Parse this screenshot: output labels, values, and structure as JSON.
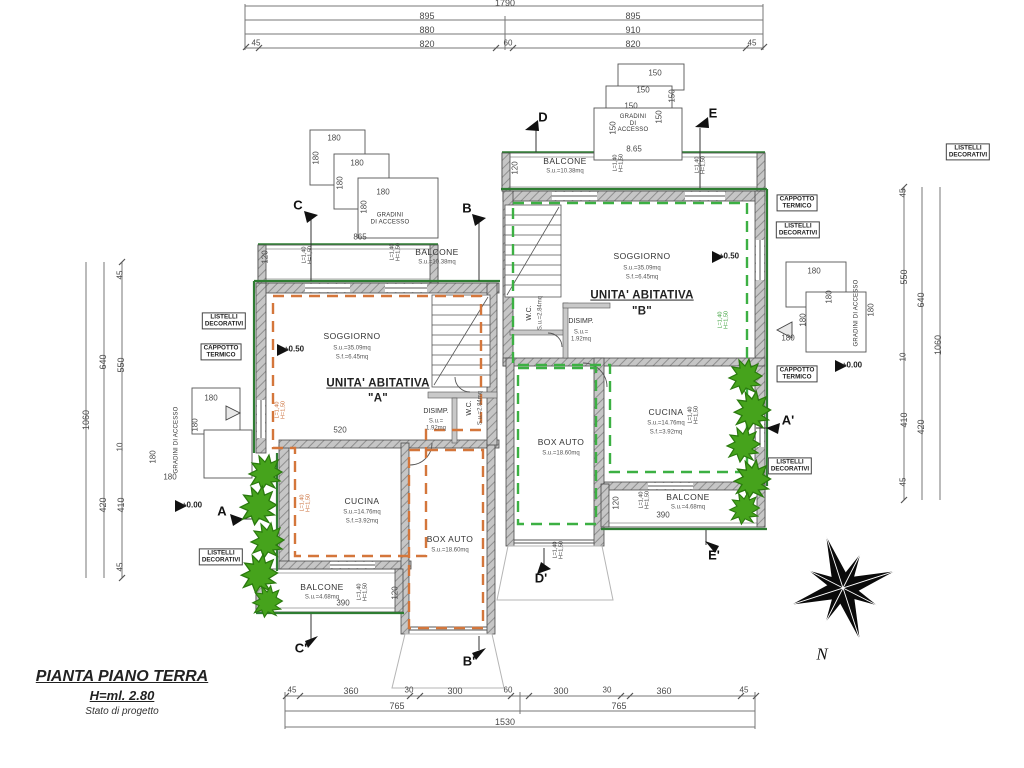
{
  "meta": {
    "width": 1024,
    "height": 768,
    "drawing_type": "floor plan"
  },
  "title_block": {
    "title": "PIANTA PIANO TERRA",
    "height_label": "H=ml. 2.80",
    "status": "Stato di progetto"
  },
  "compass": {
    "north_label": "N"
  },
  "colors": {
    "wall_fill": "#c6c6c6",
    "wall_edge": "#4a4a4a",
    "trim_green": "#2e7d32",
    "unit_a_dash": "#d4763b",
    "unit_b_dash": "#3cb043",
    "foliage": "#46a31c",
    "dim_line": "#777777"
  },
  "annotations": [
    {
      "n": "dim-top-total",
      "c": "dim",
      "t": "1790",
      "x": 505,
      "y": 3
    },
    {
      "n": "dim-top-895-left",
      "c": "dim",
      "t": "895",
      "x": 427,
      "y": 16
    },
    {
      "n": "dim-top-895-right",
      "c": "dim",
      "t": "895",
      "x": 633,
      "y": 16
    },
    {
      "n": "dim-top-880",
      "c": "dim",
      "t": "880",
      "x": 427,
      "y": 30
    },
    {
      "n": "dim-top-910",
      "c": "dim",
      "t": "910",
      "x": 633,
      "y": 30
    },
    {
      "n": "dim-top-45-left",
      "c": "dimsm",
      "t": "45",
      "x": 256,
      "y": 44
    },
    {
      "n": "dim-top-820-left",
      "c": "dim",
      "t": "820",
      "x": 427,
      "y": 44
    },
    {
      "n": "dim-top-60",
      "c": "dimsm",
      "t": "60",
      "x": 508,
      "y": 44
    },
    {
      "n": "dim-top-820-right",
      "c": "dim",
      "t": "820",
      "x": 633,
      "y": 44
    },
    {
      "n": "dim-top-45-right",
      "c": "dimsm",
      "t": "45",
      "x": 752,
      "y": 44
    },
    {
      "n": "dim-bot-45-a",
      "c": "dimsm",
      "t": "45",
      "x": 292,
      "y": 691
    },
    {
      "n": "dim-bot-360-a",
      "c": "dim",
      "t": "360",
      "x": 351,
      "y": 691
    },
    {
      "n": "dim-bot-30-a",
      "c": "dimsm",
      "t": "30",
      "x": 409,
      "y": 691
    },
    {
      "n": "dim-bot-300-a",
      "c": "dim",
      "t": "300",
      "x": 455,
      "y": 691
    },
    {
      "n": "dim-bot-60",
      "c": "dimsm",
      "t": "60",
      "x": 508,
      "y": 691
    },
    {
      "n": "dim-bot-300-b",
      "c": "dim",
      "t": "300",
      "x": 561,
      "y": 691
    },
    {
      "n": "dim-bot-30-b",
      "c": "dimsm",
      "t": "30",
      "x": 607,
      "y": 691
    },
    {
      "n": "dim-bot-360-b",
      "c": "dim",
      "t": "360",
      "x": 664,
      "y": 691
    },
    {
      "n": "dim-bot-45-b",
      "c": "dimsm",
      "t": "45",
      "x": 744,
      "y": 691
    },
    {
      "n": "dim-bot-765-a",
      "c": "dim",
      "t": "765",
      "x": 397,
      "y": 706
    },
    {
      "n": "dim-bot-765-b",
      "c": "dim",
      "t": "765",
      "x": 619,
      "y": 706
    },
    {
      "n": "dim-bot-1530",
      "c": "dim",
      "t": "1530",
      "x": 505,
      "y": 722
    },
    {
      "n": "dim-left-1060",
      "c": "dim",
      "t": "1060",
      "x": 86,
      "y": 420,
      "r": -90
    },
    {
      "n": "dim-left-640",
      "c": "dim",
      "t": "640",
      "x": 103,
      "y": 362,
      "r": -90
    },
    {
      "n": "dim-left-420",
      "c": "dim",
      "t": "420",
      "x": 103,
      "y": 505,
      "r": -90
    },
    {
      "n": "dim-left-45-top",
      "c": "dimsm",
      "t": "45",
      "x": 121,
      "y": 275,
      "r": -90
    },
    {
      "n": "dim-left-550",
      "c": "dim",
      "t": "550",
      "x": 121,
      "y": 365,
      "r": -90
    },
    {
      "n": "dim-left-10",
      "c": "dimsm",
      "t": "10",
      "x": 121,
      "y": 447,
      "r": -90
    },
    {
      "n": "dim-left-410",
      "c": "dim",
      "t": "410",
      "x": 121,
      "y": 505,
      "r": -90
    },
    {
      "n": "dim-left-45-bot",
      "c": "dimsm",
      "t": "45",
      "x": 121,
      "y": 567,
      "r": -90
    },
    {
      "n": "dim-right-1060",
      "c": "dim",
      "t": "1060",
      "x": 938,
      "y": 345,
      "r": -90
    },
    {
      "n": "dim-right-640",
      "c": "dim",
      "t": "640",
      "x": 921,
      "y": 300,
      "r": -90
    },
    {
      "n": "dim-right-420",
      "c": "dim",
      "t": "420",
      "x": 921,
      "y": 427,
      "r": -90
    },
    {
      "n": "dim-right-45-top",
      "c": "dimsm",
      "t": "45",
      "x": 904,
      "y": 193,
      "r": -90
    },
    {
      "n": "dim-right-550",
      "c": "dim",
      "t": "550",
      "x": 904,
      "y": 277,
      "r": -90
    },
    {
      "n": "dim-right-10",
      "c": "dimsm",
      "t": "10",
      "x": 904,
      "y": 357,
      "r": -90
    },
    {
      "n": "dim-right-410",
      "c": "dim",
      "t": "410",
      "x": 904,
      "y": 420,
      "r": -90
    },
    {
      "n": "dim-right-45-bot",
      "c": "dimsm",
      "t": "45",
      "x": 904,
      "y": 482,
      "r": -90
    },
    {
      "n": "dim-865",
      "c": "dimsm",
      "t": "865",
      "x": 360,
      "y": 238
    },
    {
      "n": "dim-865-b",
      "c": "dimsm",
      "t": "8.65",
      "x": 634,
      "y": 150
    },
    {
      "n": "dim-520",
      "c": "dimsm",
      "t": "520",
      "x": 340,
      "y": 431
    },
    {
      "n": "dim-390-a",
      "c": "dimsm",
      "t": "390",
      "x": 343,
      "y": 604
    },
    {
      "n": "dim-390-b",
      "c": "dimsm",
      "t": "390",
      "x": 663,
      "y": 516
    },
    {
      "n": "dim-120-a-top",
      "c": "dimsm",
      "t": "120",
      "x": 266,
      "y": 257,
      "r": -90
    },
    {
      "n": "dim-120-a-bot",
      "c": "dimsm",
      "t": "120",
      "x": 396,
      "y": 593,
      "r": -90
    },
    {
      "n": "dim-120-b-top",
      "c": "dimsm",
      "t": "120",
      "x": 516,
      "y": 168,
      "r": -90
    },
    {
      "n": "dim-120-b-bot",
      "c": "dimsm",
      "t": "120",
      "x": 617,
      "y": 503,
      "r": -90
    },
    {
      "n": "dim-180-tl1",
      "c": "dimsm",
      "t": "180",
      "x": 334,
      "y": 139
    },
    {
      "n": "dim-180-tl2",
      "c": "dimsm",
      "t": "180",
      "x": 357,
      "y": 164
    },
    {
      "n": "dim-180-tl3",
      "c": "dimsm",
      "t": "180",
      "x": 383,
      "y": 193
    },
    {
      "n": "dim-180-tl4",
      "c": "dimsm",
      "t": "180",
      "x": 317,
      "y": 158,
      "r": -90
    },
    {
      "n": "dim-180-tl5",
      "c": "dimsm",
      "t": "180",
      "x": 341,
      "y": 183,
      "r": -90
    },
    {
      "n": "dim-180-tl6",
      "c": "dimsm",
      "t": "180",
      "x": 365,
      "y": 207,
      "r": -90
    },
    {
      "n": "dim-150-tc1",
      "c": "dimsm",
      "t": "150",
      "x": 655,
      "y": 74
    },
    {
      "n": "dim-150-tc2",
      "c": "dimsm",
      "t": "150",
      "x": 643,
      "y": 91
    },
    {
      "n": "dim-150-tc3",
      "c": "dimsm",
      "t": "150",
      "x": 631,
      "y": 107
    },
    {
      "n": "dim-150-tc4",
      "c": "dimsm",
      "t": "150",
      "x": 673,
      "y": 96,
      "r": -90
    },
    {
      "n": "dim-150-tc5",
      "c": "dimsm",
      "t": "150",
      "x": 660,
      "y": 117,
      "r": -90
    },
    {
      "n": "dim-150-tc6",
      "c": "dimsm",
      "t": "150",
      "x": 614,
      "y": 128,
      "r": -90
    },
    {
      "n": "dim-180-r1",
      "c": "dimsm",
      "t": "180",
      "x": 814,
      "y": 272
    },
    {
      "n": "dim-180-r2",
      "c": "dimsm",
      "t": "180",
      "x": 788,
      "y": 339
    },
    {
      "n": "dim-180-r3",
      "c": "dimsm",
      "t": "180",
      "x": 830,
      "y": 297,
      "r": -90
    },
    {
      "n": "dim-180-r4",
      "c": "dimsm",
      "t": "180",
      "x": 804,
      "y": 320,
      "r": -90
    },
    {
      "n": "dim-180-r5",
      "c": "dimsm",
      "t": "180",
      "x": 872,
      "y": 310,
      "r": -90
    },
    {
      "n": "dim-180-l1",
      "c": "dimsm",
      "t": "180",
      "x": 211,
      "y": 399
    },
    {
      "n": "dim-180-l2",
      "c": "dimsm",
      "t": "180",
      "x": 170,
      "y": 478
    },
    {
      "n": "dim-180-l3",
      "c": "dimsm",
      "t": "180",
      "x": 196,
      "y": 425,
      "r": -90
    },
    {
      "n": "dim-180-l4",
      "c": "dimsm",
      "t": "180",
      "x": 154,
      "y": 457,
      "r": -90
    },
    {
      "n": "room-soggiorno-a",
      "c": "room",
      "t": "SOGGIORNO",
      "x": 352,
      "y": 337
    },
    {
      "n": "area-soggiorno-a-1",
      "c": "area",
      "t": "S.u.=35.09mq",
      "x": 352,
      "y": 349
    },
    {
      "n": "area-soggiorno-a-2",
      "c": "area",
      "t": "S.f.=6.45mq",
      "x": 352,
      "y": 358
    },
    {
      "n": "unit-a-title",
      "c": "bigu",
      "t": "UNITA' ABITATIVA",
      "x": 378,
      "y": 384
    },
    {
      "n": "unit-a-letter",
      "c": "big",
      "t": "\"A\"",
      "x": 378,
      "y": 399
    },
    {
      "n": "level-a",
      "c": "lvl",
      "t": "+0.50",
      "x": 294,
      "y": 350
    },
    {
      "n": "room-wc-a",
      "c": "small",
      "t": "W.C.",
      "x": 470,
      "y": 408,
      "r": -90
    },
    {
      "n": "area-wc-a",
      "c": "area",
      "t": "S.u.=2.84mq",
      "x": 481,
      "y": 408,
      "r": -90
    },
    {
      "n": "room-disimp-a",
      "c": "small",
      "t": "DISIMP.",
      "x": 436,
      "y": 412
    },
    {
      "n": "area-disimp-a",
      "c": "area",
      "t": "S.u.=\n1.92mq",
      "x": 436,
      "y": 425
    },
    {
      "n": "room-cucina-a",
      "c": "room",
      "t": "CUCINA",
      "x": 362,
      "y": 502
    },
    {
      "n": "area-cucina-a-1",
      "c": "area",
      "t": "S.u.=14.76mq",
      "x": 362,
      "y": 513
    },
    {
      "n": "area-cucina-a-2",
      "c": "area",
      "t": "S.f.=3.92mq",
      "x": 362,
      "y": 522
    },
    {
      "n": "room-boxauto-a",
      "c": "room",
      "t": "BOX AUTO",
      "x": 450,
      "y": 540
    },
    {
      "n": "area-boxauto-a",
      "c": "area",
      "t": "S.u.=18.60mq",
      "x": 450,
      "y": 551
    },
    {
      "n": "room-balcone-a-top",
      "c": "room",
      "t": "BALCONE",
      "x": 437,
      "y": 253
    },
    {
      "n": "area-balcone-a-top",
      "c": "area",
      "t": "S.u.=10.38mq",
      "x": 437,
      "y": 263
    },
    {
      "n": "room-balcone-a-bot",
      "c": "room",
      "t": "BALCONE",
      "x": 322,
      "y": 588
    },
    {
      "n": "area-balcone-a-bot",
      "c": "area",
      "t": "S.u.=4.68mq",
      "x": 322,
      "y": 598
    },
    {
      "n": "room-soggiorno-b",
      "c": "room",
      "t": "SOGGIORNO",
      "x": 642,
      "y": 257
    },
    {
      "n": "area-soggiorno-b-1",
      "c": "area",
      "t": "S.u.=35.09mq",
      "x": 642,
      "y": 269
    },
    {
      "n": "area-soggiorno-b-2",
      "c": "area",
      "t": "S.f.=6.45mq",
      "x": 642,
      "y": 278
    },
    {
      "n": "unit-b-title",
      "c": "bigu",
      "t": "UNITA' ABITATIVA",
      "x": 642,
      "y": 296
    },
    {
      "n": "unit-b-letter",
      "c": "big",
      "t": "\"B\"",
      "x": 642,
      "y": 312
    },
    {
      "n": "level-b",
      "c": "lvl",
      "t": "+0.50",
      "x": 729,
      "y": 257
    },
    {
      "n": "room-wc-b",
      "c": "small",
      "t": "W.C.",
      "x": 530,
      "y": 313,
      "r": -90
    },
    {
      "n": "area-wc-b",
      "c": "area",
      "t": "S.u.=2.84mq",
      "x": 541,
      "y": 313,
      "r": -90
    },
    {
      "n": "room-disimp-b",
      "c": "small",
      "t": "DISIMP.",
      "x": 581,
      "y": 322
    },
    {
      "n": "area-disimp-b",
      "c": "area",
      "t": "S.u.=\n1.92mq",
      "x": 581,
      "y": 336
    },
    {
      "n": "room-cucina-b",
      "c": "room",
      "t": "CUCINA",
      "x": 666,
      "y": 413
    },
    {
      "n": "area-cucina-b-1",
      "c": "area",
      "t": "S.u.=14.76mq",
      "x": 666,
      "y": 424
    },
    {
      "n": "area-cucina-b-2",
      "c": "area",
      "t": "S.f.=3.92mq",
      "x": 666,
      "y": 433
    },
    {
      "n": "room-boxauto-b",
      "c": "room",
      "t": "BOX AUTO",
      "x": 561,
      "y": 443
    },
    {
      "n": "area-boxauto-b",
      "c": "area",
      "t": "S.u.=18.60mq",
      "x": 561,
      "y": 454
    },
    {
      "n": "room-balcone-b-top",
      "c": "room",
      "t": "BALCONE",
      "x": 565,
      "y": 162
    },
    {
      "n": "area-balcone-b-top",
      "c": "area",
      "t": "S.u.=10.38mq",
      "x": 565,
      "y": 172
    },
    {
      "n": "room-balcone-b-bot",
      "c": "room",
      "t": "BALCONE",
      "x": 688,
      "y": 498
    },
    {
      "n": "area-balcone-b-bot",
      "c": "area",
      "t": "S.u.=4.68mq",
      "x": 688,
      "y": 508
    },
    {
      "n": "section-c",
      "c": "sec",
      "t": "C",
      "x": 298,
      "y": 206
    },
    {
      "n": "section-b",
      "c": "sec",
      "t": "B",
      "x": 467,
      "y": 209
    },
    {
      "n": "section-d",
      "c": "sec",
      "t": "D",
      "x": 543,
      "y": 118
    },
    {
      "n": "section-e",
      "c": "sec",
      "t": "E",
      "x": 713,
      "y": 114
    },
    {
      "n": "section-a",
      "c": "sec",
      "t": "A",
      "x": 222,
      "y": 512
    },
    {
      "n": "section-a1",
      "c": "sec",
      "t": "A'",
      "x": 788,
      "y": 421
    },
    {
      "n": "section-c1",
      "c": "sec",
      "t": "C'",
      "x": 301,
      "y": 649
    },
    {
      "n": "section-b1",
      "c": "sec",
      "t": "B'",
      "x": 469,
      "y": 662
    },
    {
      "n": "section-d1",
      "c": "sec",
      "t": "D'",
      "x": 541,
      "y": 579
    },
    {
      "n": "section-e1",
      "c": "sec",
      "t": "E'",
      "x": 714,
      "y": 556
    },
    {
      "n": "level-zero-left",
      "c": "lvl",
      "t": "+0.00",
      "x": 192,
      "y": 506
    },
    {
      "n": "level-zero-right",
      "c": "lvl",
      "t": "+0.00",
      "x": 852,
      "y": 366
    },
    {
      "n": "label-listelli-left",
      "c": "box",
      "t": "LISTELLI\nDECORATIVI",
      "x": 224,
      "y": 321
    },
    {
      "n": "label-cappotto-left",
      "c": "box",
      "t": "CAPPOTTO\nTERMICO",
      "x": 221,
      "y": 352
    },
    {
      "n": "label-listelli-left-bot",
      "c": "box",
      "t": "LISTELLI\nDECORATIVI",
      "x": 221,
      "y": 557
    },
    {
      "n": "label-cappotto-right-top",
      "c": "box",
      "t": "CAPPOTTO\nTERMICO",
      "x": 797,
      "y": 203
    },
    {
      "n": "label-listelli-right-top",
      "c": "box",
      "t": "LISTELLI\nDECORATIVI",
      "x": 798,
      "y": 230
    },
    {
      "n": "label-cappotto-right-bot",
      "c": "box",
      "t": "CAPPOTTO\nTERMICO",
      "x": 797,
      "y": 374
    },
    {
      "n": "label-listelli-right-bot",
      "c": "box",
      "t": "LISTELLI\nDECORATIVI",
      "x": 790,
      "y": 466
    },
    {
      "n": "label-listelli-corner",
      "c": "box",
      "t": "LISTELLI\nDECORATIVI",
      "x": 968,
      "y": 152
    },
    {
      "n": "label-gradini-tl",
      "c": "gradini",
      "t": "GRADINI\nDI ACCESSO",
      "x": 390,
      "y": 219
    },
    {
      "n": "label-gradini-tc",
      "c": "gradini",
      "t": "GRADINI\nDI\nACCESSO",
      "x": 633,
      "y": 124
    },
    {
      "n": "label-gradini-right",
      "c": "gradini",
      "t": "GRADINI DI ACCESSO",
      "x": 857,
      "y": 313,
      "r": -90
    },
    {
      "n": "label-gradini-left",
      "c": "gradini",
      "t": "GRADINI DI ACCESSO",
      "x": 177,
      "y": 440,
      "r": -90
    },
    {
      "n": "window-tag",
      "c": "tag",
      "t": "L=1,40\nH=1,50",
      "x": 308,
      "y": 255,
      "r": -90
    },
    {
      "n": "window-tag",
      "c": "tag",
      "t": "L=1,40\nH=1,50",
      "x": 396,
      "y": 252,
      "r": -90
    },
    {
      "n": "window-tag",
      "c": "tag",
      "t": "L=1,40\nH=1,50",
      "x": 619,
      "y": 163,
      "r": -90
    },
    {
      "n": "window-tag",
      "c": "tag",
      "t": "L=1,40\nH=1,50",
      "x": 701,
      "y": 165,
      "r": -90
    },
    {
      "n": "window-tag",
      "c": "tag",
      "t": "L=1,40\nH=1,50",
      "x": 363,
      "y": 592,
      "r": -90
    },
    {
      "n": "window-tag",
      "c": "tag",
      "t": "L=1,40\nH=1,50",
      "x": 559,
      "y": 550,
      "r": -90
    },
    {
      "n": "window-tag",
      "c": "tag",
      "t": "L=1,40\nH=1,50",
      "x": 694,
      "y": 415,
      "r": -90
    },
    {
      "n": "window-tag",
      "c": "tag",
      "t": "L=1,40\nH=1,50",
      "x": 645,
      "y": 500,
      "r": -90
    },
    {
      "n": "window-tag",
      "c": "tagor",
      "t": "L=1,40\nH=1,50",
      "x": 281,
      "y": 410,
      "r": -90
    },
    {
      "n": "window-tag",
      "c": "tagor",
      "t": "L=1,40\nH=1,50",
      "x": 306,
      "y": 503,
      "r": -90
    },
    {
      "n": "window-tag",
      "c": "taggr",
      "t": "L=1,40\nH=1,50",
      "x": 724,
      "y": 320,
      "r": -90
    },
    {
      "n": "compass-north-label",
      "c": "nlabel",
      "t": "N",
      "x": 822,
      "y": 654
    }
  ]
}
